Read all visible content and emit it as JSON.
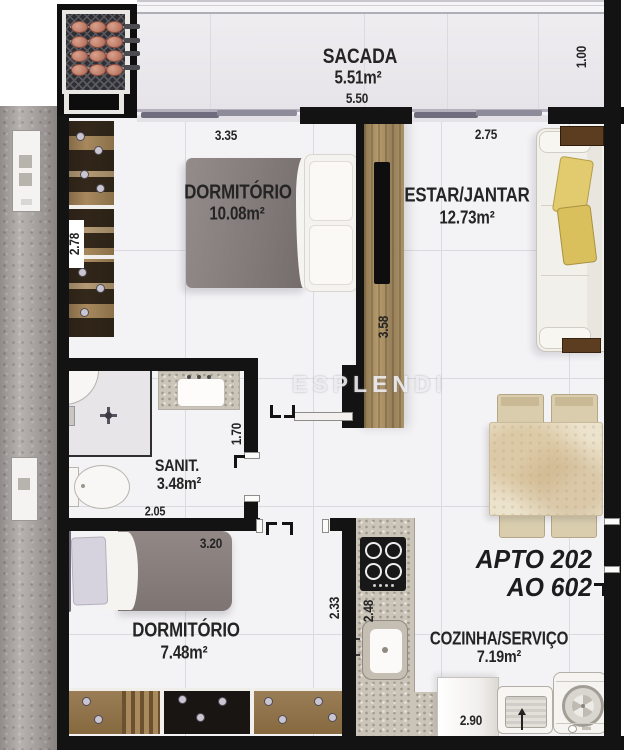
{
  "plan": {
    "watermark": "ESPLENDI",
    "unit": {
      "line1": "APTO 202",
      "line2": "AO 602"
    },
    "rooms": {
      "sacada": {
        "name": "SACADA",
        "area": "5.51m²"
      },
      "dorm1": {
        "name": "DORMITÓRIO",
        "area": "10.08m²"
      },
      "estar": {
        "name": "ESTAR/JANTAR",
        "area": "12.73m²"
      },
      "sanit": {
        "name": "SANIT.",
        "area": "3.48m²"
      },
      "dorm2": {
        "name": "DORMITÓRIO",
        "area": "7.48m²"
      },
      "cozinha": {
        "name": "COZINHA/SERVIÇO",
        "area": "7.19m²"
      }
    },
    "dimensions": {
      "sacada_width": "5.50",
      "sacada_depth": "1.00",
      "dorm1_width": "3.35",
      "dorm1_closet": "2.78",
      "estar_width": "2.75",
      "estar_depth": "3.58",
      "sanit_width": "2.05",
      "sanit_pass": "1.70",
      "dorm2_width": "3.20",
      "dorm2_depth": "2.33",
      "cozinha_depth": "2.48",
      "cozinha_width": "2.90"
    },
    "colors": {
      "wall": "#131313",
      "floor": "#f3f2f4",
      "wood": "#a0875d",
      "cushion": "#dfc567"
    }
  }
}
